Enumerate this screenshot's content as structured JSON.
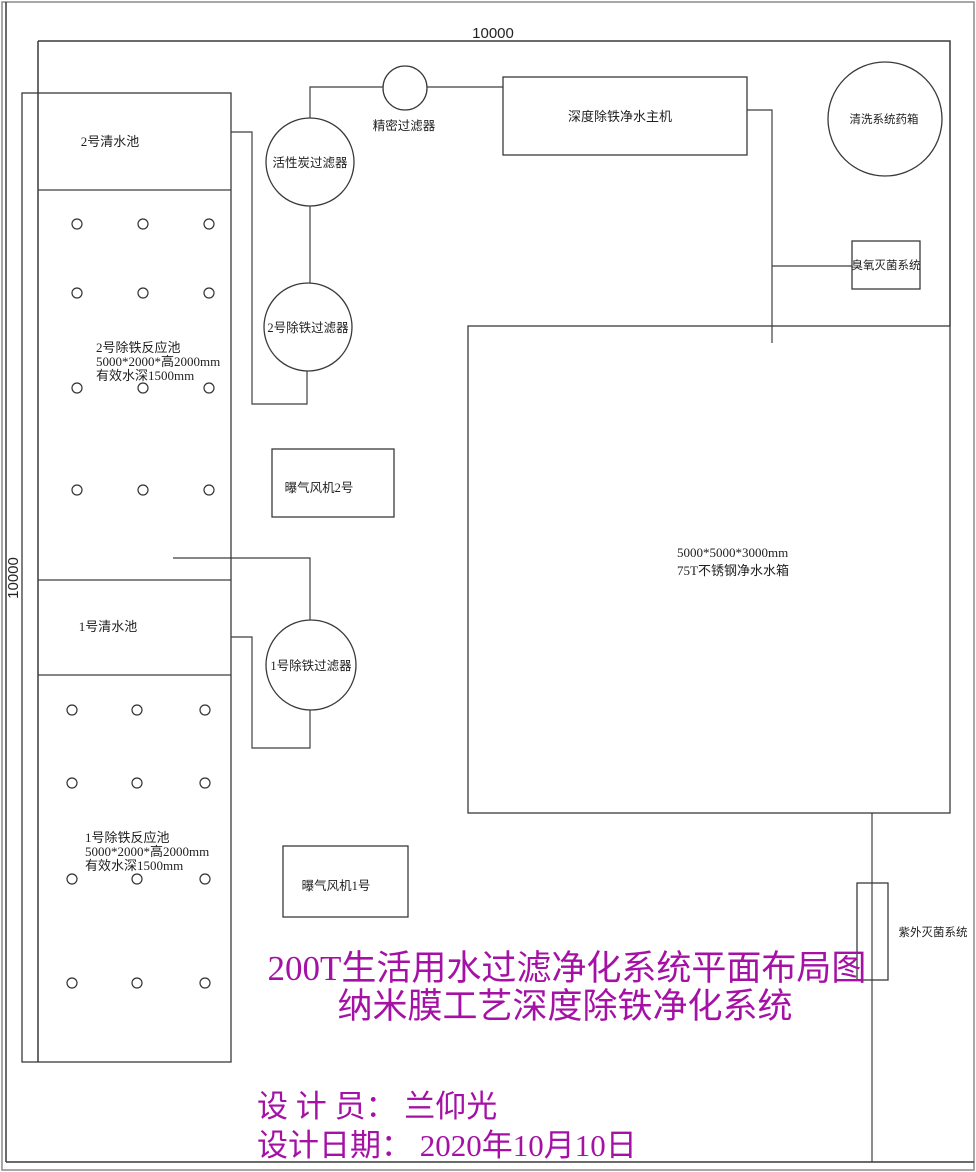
{
  "dimensions": {
    "top": "10000",
    "left": "10000"
  },
  "pool_area": {
    "pool2": {
      "clear_label": "2号清水池",
      "reaction_name": "2号除铁反应池",
      "reaction_size": "5000*2000*高2000mm",
      "reaction_depth": "有效水深1500mm"
    },
    "pool1": {
      "clear_label": "1号清水池",
      "reaction_name": "1号除铁反应池",
      "reaction_size": "5000*2000*高2000mm",
      "reaction_depth": "有效水深1500mm"
    },
    "fan2_label": "曝气风机2号",
    "fan1_label": "曝气风机1号"
  },
  "treatment": {
    "precision_filter": "精密过滤器",
    "carbon_filter": "活性炭过滤器",
    "iron_filter_2": "2号除铁过滤器",
    "iron_filter_1": "1号除铁过滤器",
    "main_unit": "深度除铁净水主机",
    "chem_tank": "清洗系统药箱",
    "ozone": "臭氧灭菌系统",
    "uv": "紫外灭菌系统"
  },
  "storage_tank": {
    "size": "5000*5000*3000mm",
    "name": "75T不锈钢净水水箱"
  },
  "title": {
    "line1": "200T生活用水过滤净化系统平面布局图",
    "line2": "纳米膜工艺深度除铁净化系统"
  },
  "footer": {
    "designer": "设 计 员： 兰仰光",
    "date": "设计日期： 2020年10月10日"
  },
  "colors": {
    "title_text": "#a511a5",
    "line": "#3f3f3f"
  }
}
